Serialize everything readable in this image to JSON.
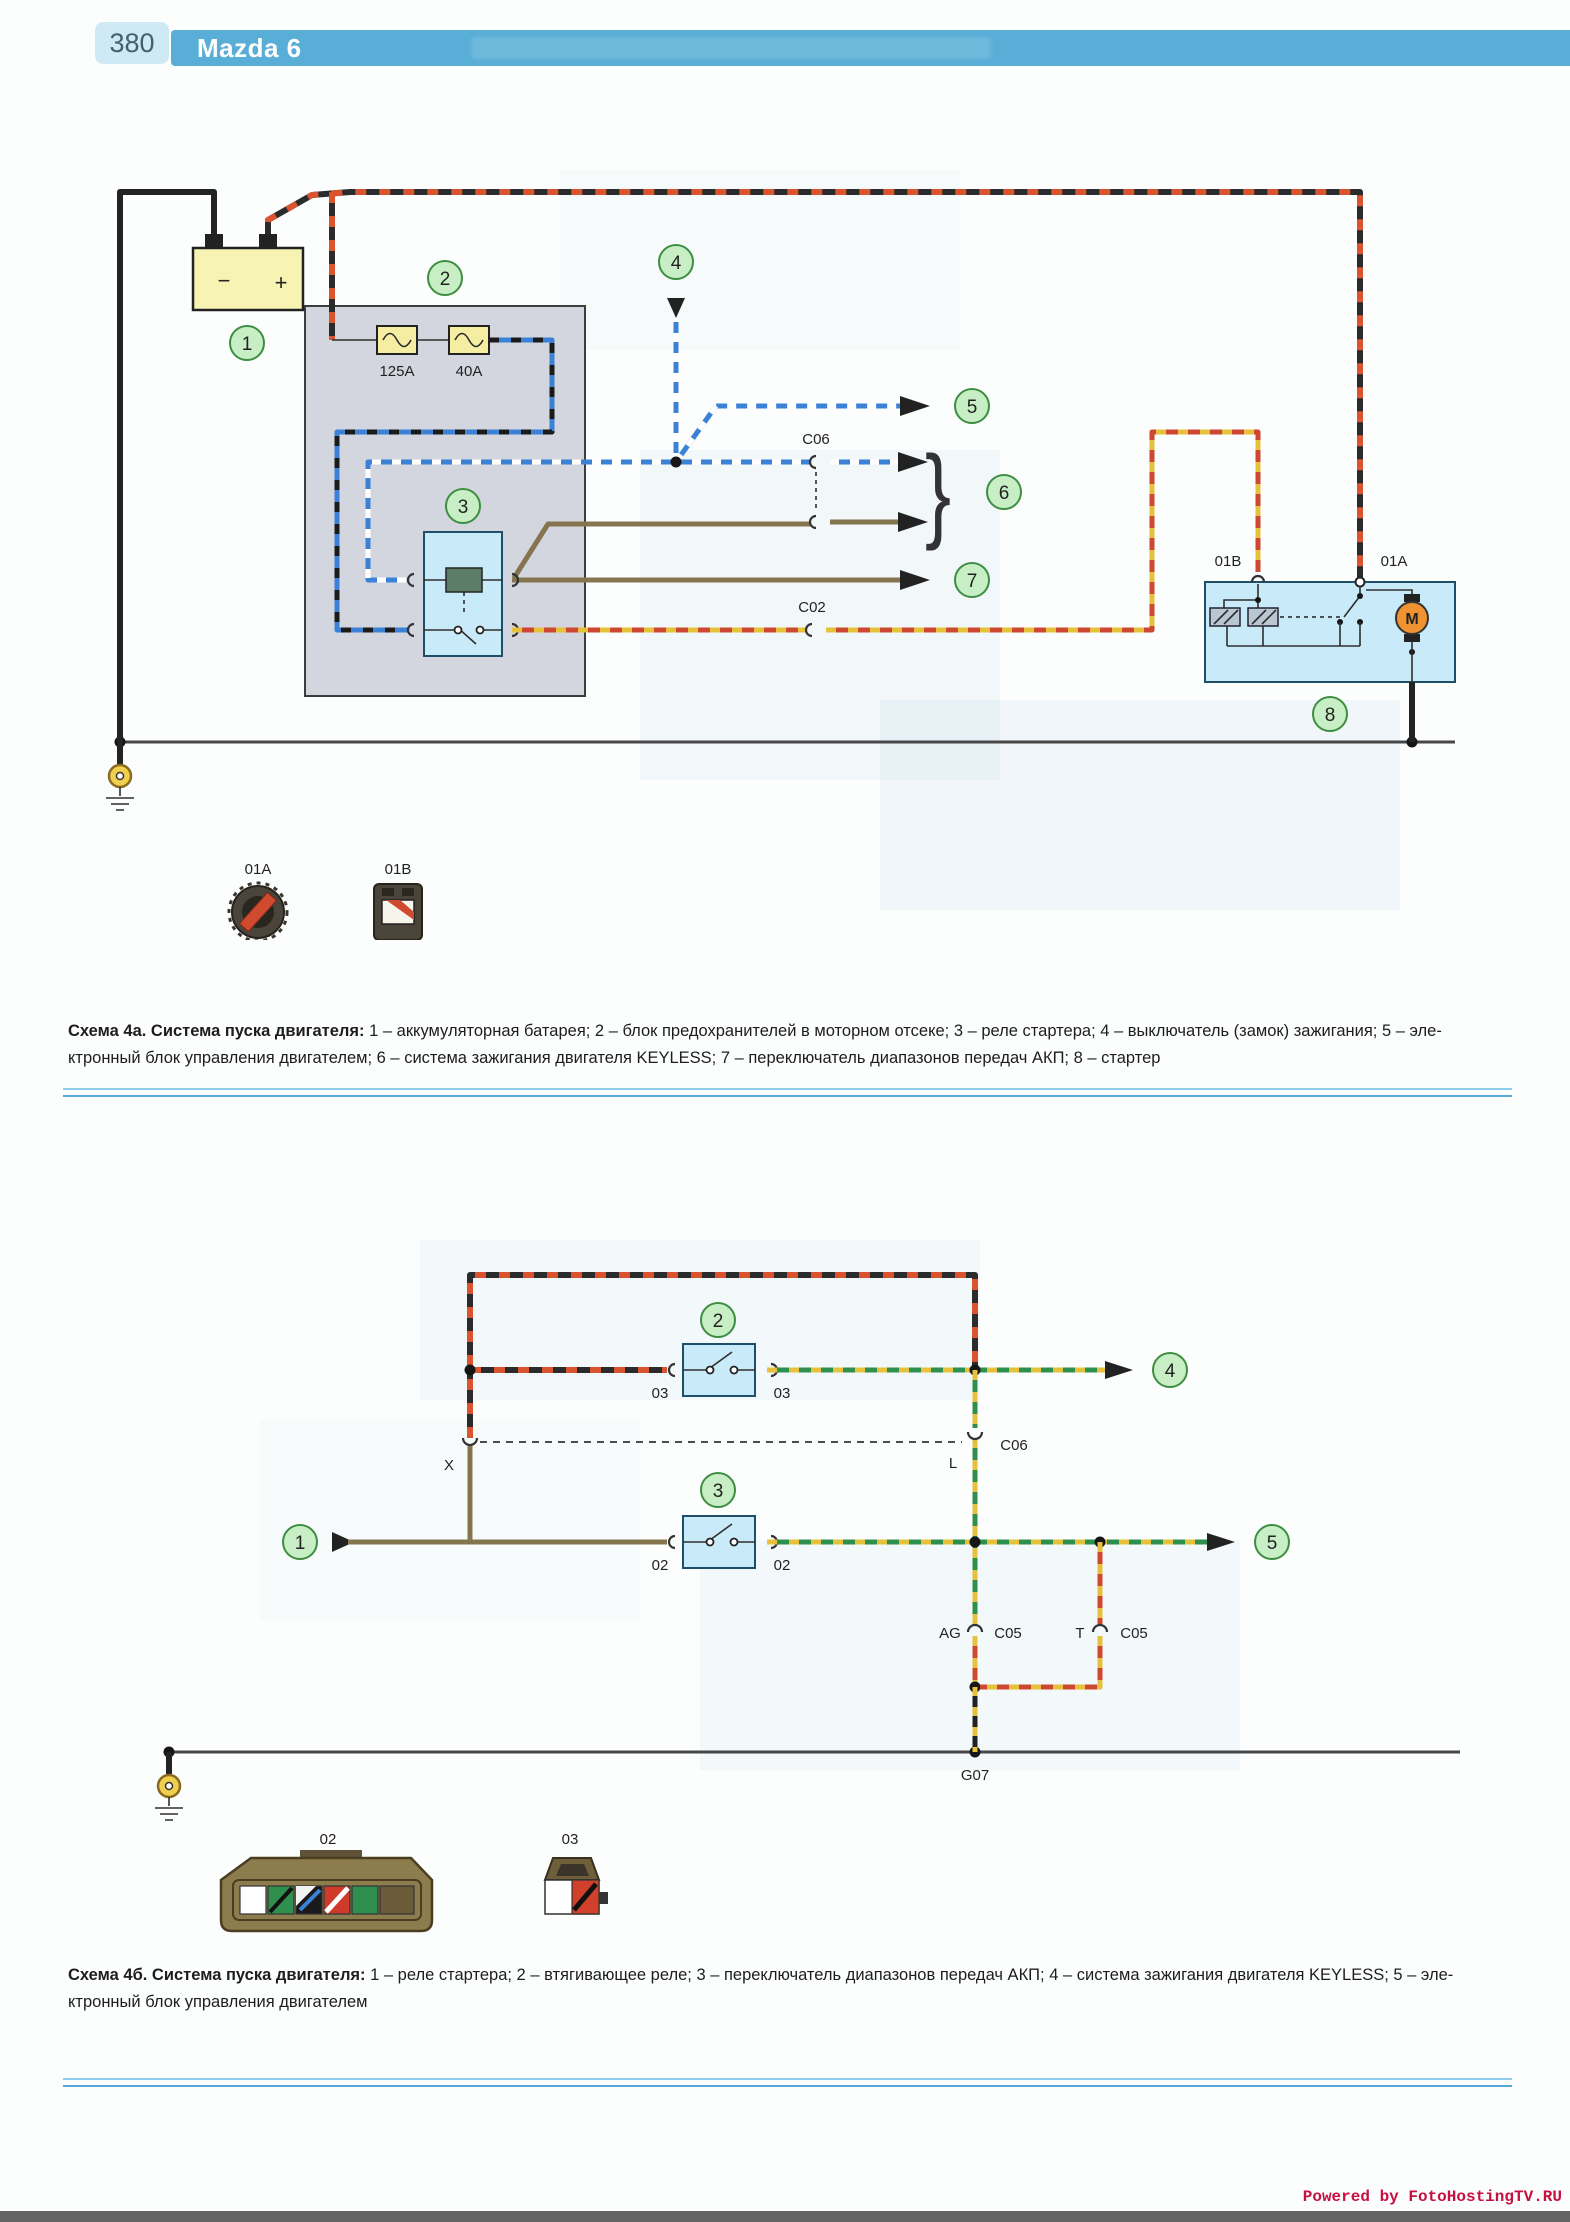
{
  "header": {
    "page_number": "380",
    "title": "Mazda 6"
  },
  "colors": {
    "header_blue": "#58aed7",
    "pagenum_bg": "#cfe9f5",
    "rule_blue": "#55a8d8",
    "footer_red": "#c81040",
    "callout_green": "#c8eec6"
  },
  "diagram_a": {
    "callouts": [
      "1",
      "2",
      "3",
      "4",
      "5",
      "6",
      "7",
      "8"
    ],
    "battery": {
      "minus": "−",
      "plus": "+"
    },
    "fuses": [
      "125A",
      "40A"
    ],
    "labels": {
      "c06": "C06",
      "c02": "C02",
      "starter_01b": "01B",
      "starter_01a": "01A",
      "motor": "M"
    },
    "brace": "}",
    "legend": [
      "01A",
      "01B"
    ]
  },
  "caption_a": {
    "title": "Схема 4а. Система пуска двигателя:",
    "line1": "1 – аккумуляторная батарея; 2 – блок предохранителей в моторном отсеке; 3 – реле стартера; 4 – выключатель (замок) зажигания; 5 – эле-",
    "line2": "ктронный блок управления двигателем; 6 – система зажигания двигателя KEYLESS; 7 – переключатель диапазонов передач АКП; 8 – стартер"
  },
  "diagram_b": {
    "callouts": [
      "1",
      "2",
      "3",
      "4",
      "5"
    ],
    "labels": {
      "x": "X",
      "l": "L",
      "c06": "C06",
      "ag": "AG",
      "c05_left": "C05",
      "t": "T",
      "c05_right": "C05",
      "g07": "G07",
      "sw2_in": "03",
      "sw2_out": "03",
      "sw3_in": "02",
      "sw3_out": "02"
    },
    "legend": [
      "02",
      "03"
    ]
  },
  "caption_b": {
    "title": "Схема 4б. Система пуска двигателя:",
    "line1": "1 – реле стартера; 2 – втягивающее реле; 3 – переключатель диапазонов передач АКП; 4 – система зажигания двигателя KEYLESS; 5 – эле-",
    "line2": "ктронный блок управления двигателем"
  },
  "footer": {
    "credit": "Powered by FotoHostingTV.RU"
  }
}
